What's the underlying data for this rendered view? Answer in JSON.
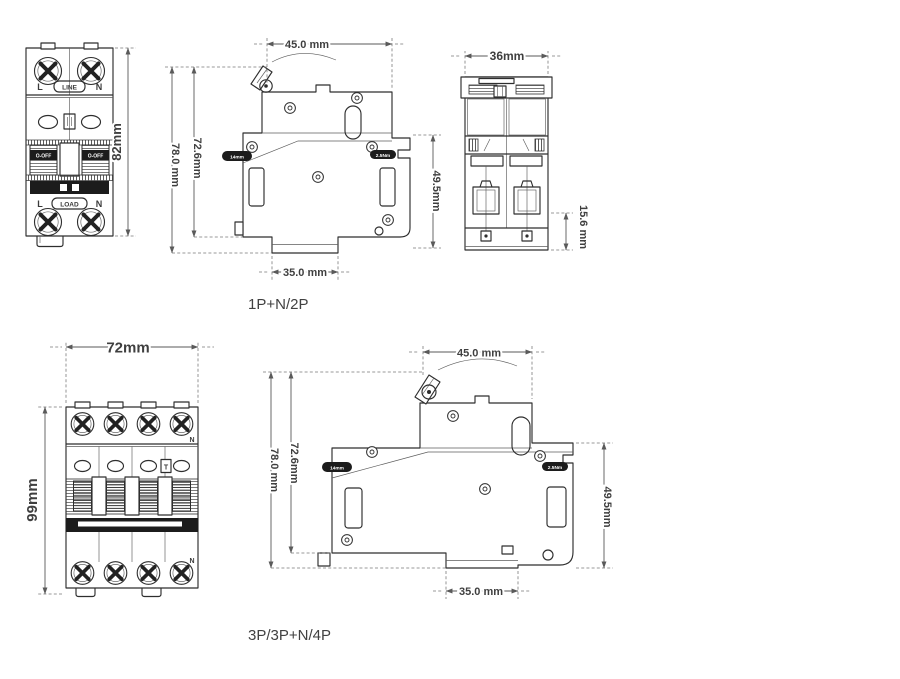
{
  "captions": {
    "group1": "1P+N/2P",
    "group2": "3P/3P+N/4P"
  },
  "front2p": {
    "terminal_top_left": "L",
    "terminal_top_right": "N",
    "line_label": "LINE",
    "toggle_left": "O-OFF",
    "toggle_right": "O-OFF",
    "terminal_bottom_left": "L",
    "terminal_bottom_right": "N",
    "load_label": "LOAD",
    "dim_height": "82mm"
  },
  "side2p": {
    "dim_width": "45.0 mm",
    "dim_h1": "72.6mm",
    "dim_h2": "78.0 mm",
    "dim_h3": "49.5mm",
    "dim_rail": "35.0 mm",
    "torque_label": "2.5Nm",
    "strip_label": "14mm"
  },
  "rear2p": {
    "dim_width": "36mm",
    "dim_depth": "15.6 mm"
  },
  "front4p": {
    "dim_width": "72mm",
    "dim_height": "99mm",
    "neutral_top": "N",
    "neutral_bottom": "N",
    "test_label": "T"
  },
  "side4p": {
    "dim_width": "45.0 mm",
    "dim_h1": "72.6mm",
    "dim_h2": "78.0 mm",
    "dim_h3": "49.5mm",
    "dim_rail": "35.0 mm",
    "torque_label": "2.5Nm",
    "strip_label": "14mm"
  },
  "colors": {
    "line": "#2e2e2e",
    "dim": "#5a5a5a",
    "dark_fill": "#1c1c1c",
    "text": "#3a3a3a"
  }
}
